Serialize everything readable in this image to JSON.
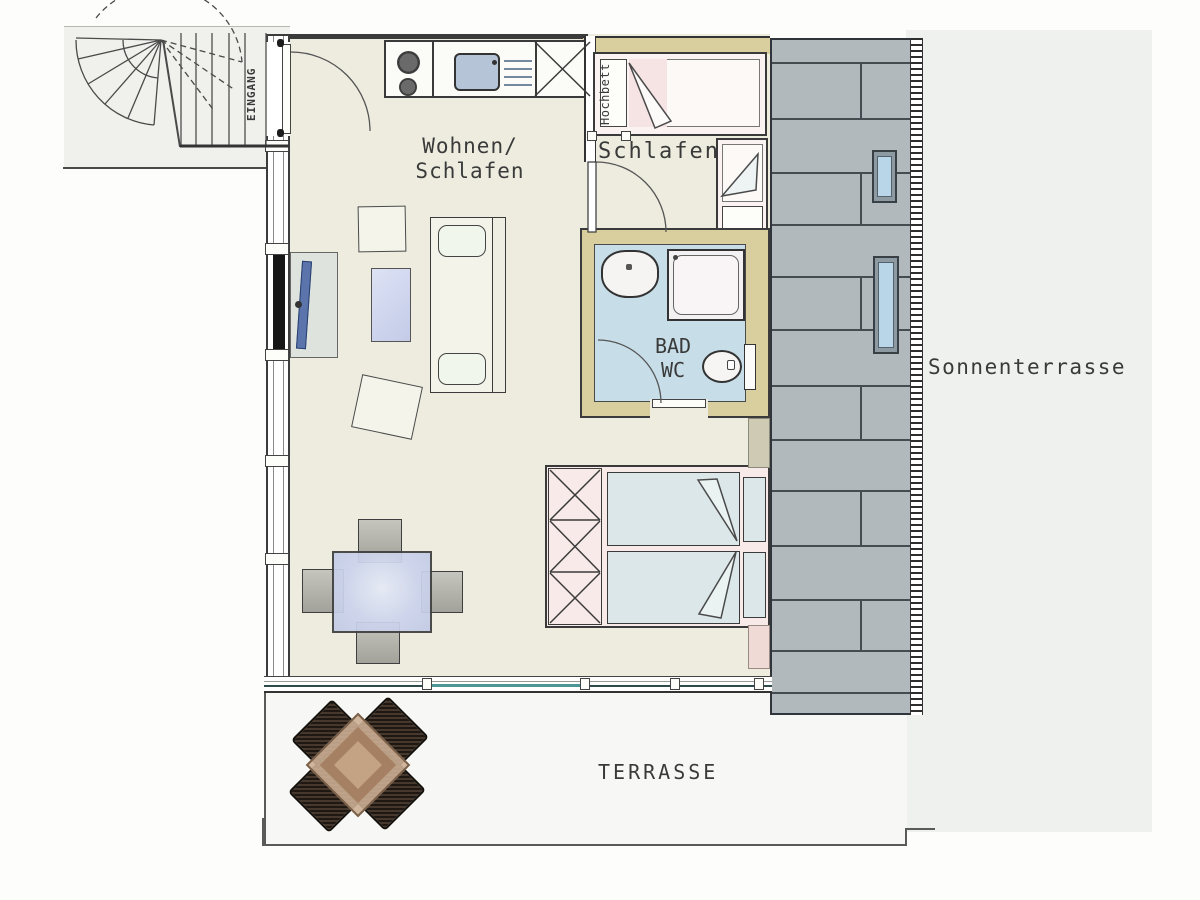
{
  "title": "Apartment floor plan",
  "labels": {
    "living1": "Wohnen/",
    "living2": "Schlafen",
    "bedroom": "Schlafen",
    "loft_bed": "Hochbett",
    "bath1": "BAD",
    "bath2": "WC",
    "entrance": "EINGANG",
    "sun_terrace": "Sonnenterrasse",
    "terrace": "TERRASSE"
  },
  "colors": {
    "floor": "#edecdf",
    "wall_tan": "#d9cf9e",
    "bath_floor": "#c7dee8",
    "deck": "#b2b9bd",
    "deck_line": "#454b50",
    "bed_pink": "#f8eae8",
    "mattress": "#dbe7e9",
    "table_blue": "#ccd4ec",
    "outside": "#eef1ed",
    "terrace_bg": "#f7f8f5",
    "landing_bg": "#f0f0ec",
    "line_dark": "#3a3a3a",
    "glass_teal": "#4d9696",
    "tv_blue": "#5b74ac",
    "lounger_blue": "#b9d6e9",
    "wood_table": "#b08d6f"
  }
}
